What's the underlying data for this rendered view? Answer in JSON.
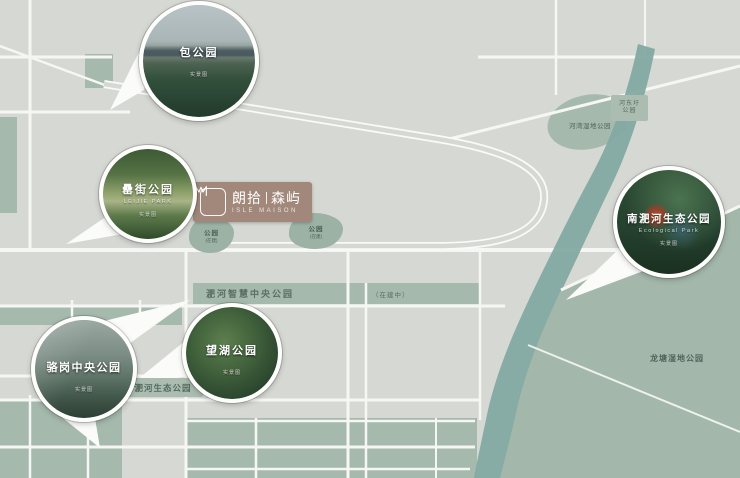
{
  "map": {
    "colors": {
      "background": "#d6d8d4",
      "road": "#f6f7f4",
      "green_block": "#a5b9ac",
      "river": "#83a9a2",
      "plaque": "#a1887b"
    },
    "logo": {
      "zh_left": "朗拾",
      "zh_right": "森屿",
      "en": "ISLE MAISON"
    },
    "labels": {
      "smart_park": "淝河智慧中央公园",
      "under_construction": "（在建中）",
      "feihe_eco_park": "淝河生态公园",
      "longtang_wetland": "龙塘湿地公园",
      "wetland_blob": "河湾湿地公园",
      "hedong_line1": "河东圩",
      "hedong_line2": "公园"
    },
    "loop_parks": [
      {
        "line1": "公园",
        "line2": "(在建)"
      },
      {
        "line1": "公园",
        "line2": "(在建)"
      }
    ],
    "callouts": [
      {
        "name": "包公园",
        "caption": "实景图"
      },
      {
        "name": "罍街公园",
        "en": "LEIJIE PARK",
        "caption": "实景图"
      },
      {
        "name": "骆岗中央公园",
        "caption": "实景图"
      },
      {
        "name": "望湖公园",
        "caption": "实景图"
      },
      {
        "name": "南淝河生态公园",
        "en": "Ecological Park",
        "caption": "实景图"
      }
    ]
  }
}
